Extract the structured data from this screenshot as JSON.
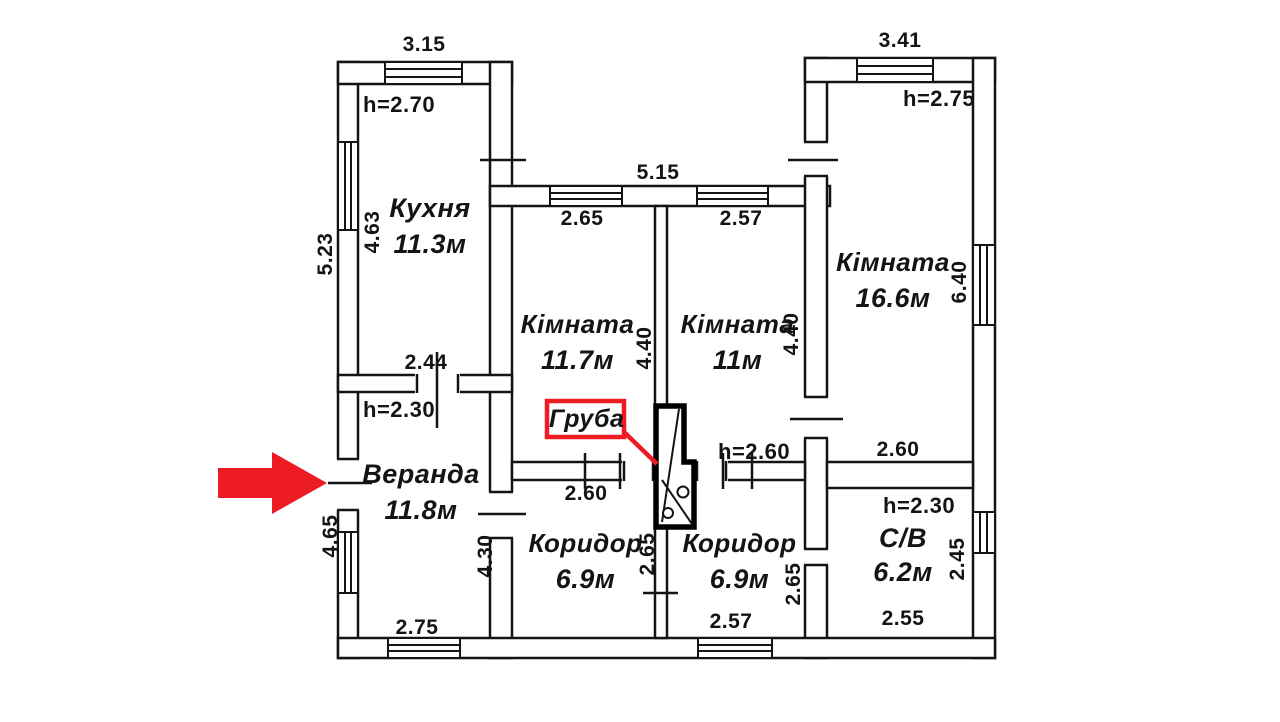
{
  "plan": {
    "rooms": {
      "kitchen": {
        "name": "Кухня",
        "area": "11.3м",
        "height": "h=2.70"
      },
      "room_a": {
        "name": "Кімната",
        "area": "11.7м"
      },
      "room_b": {
        "name": "Кімната",
        "area": "11м"
      },
      "room_c": {
        "name": "Кімната",
        "area": "16.6м",
        "height": "h=2.75"
      },
      "veranda": {
        "name": "Веранда",
        "area": "11.8м",
        "height": "h=2.30"
      },
      "corridor_a": {
        "name": "Коридор",
        "area": "6.9м"
      },
      "corridor_b": {
        "name": "Коридор",
        "area": "6.9м",
        "height": "h=2.60"
      },
      "bathroom": {
        "name": "С/В",
        "area": "6.2м",
        "height": "h=2.30"
      }
    },
    "stove": {
      "label": "Груба"
    },
    "dims": {
      "kitchen_top": "3.15",
      "left_outer": "5.23",
      "kitchen_left": "4.63",
      "middle_top": "5.15",
      "room_a_top": "2.65",
      "room_b_top": "2.57",
      "room_a_side": "4.40",
      "room_b_side": "4.40",
      "room_c_top": "3.41",
      "room_c_side": "6.40",
      "room_c_bottom": "2.60",
      "veranda_top": "2.44",
      "veranda_left": "4.65",
      "veranda_bottom": "2.75",
      "veranda_right": "4.30",
      "corridor_a_top": "2.60",
      "corridor_a_side": "2.65",
      "corridor_b_side": "2.65",
      "corridor_b_bottom": "2.57",
      "bathroom_side": "2.45",
      "bathroom_bottom": "2.55"
    },
    "colors": {
      "annotation_red": "#ed1c24",
      "line": "#141414"
    }
  }
}
